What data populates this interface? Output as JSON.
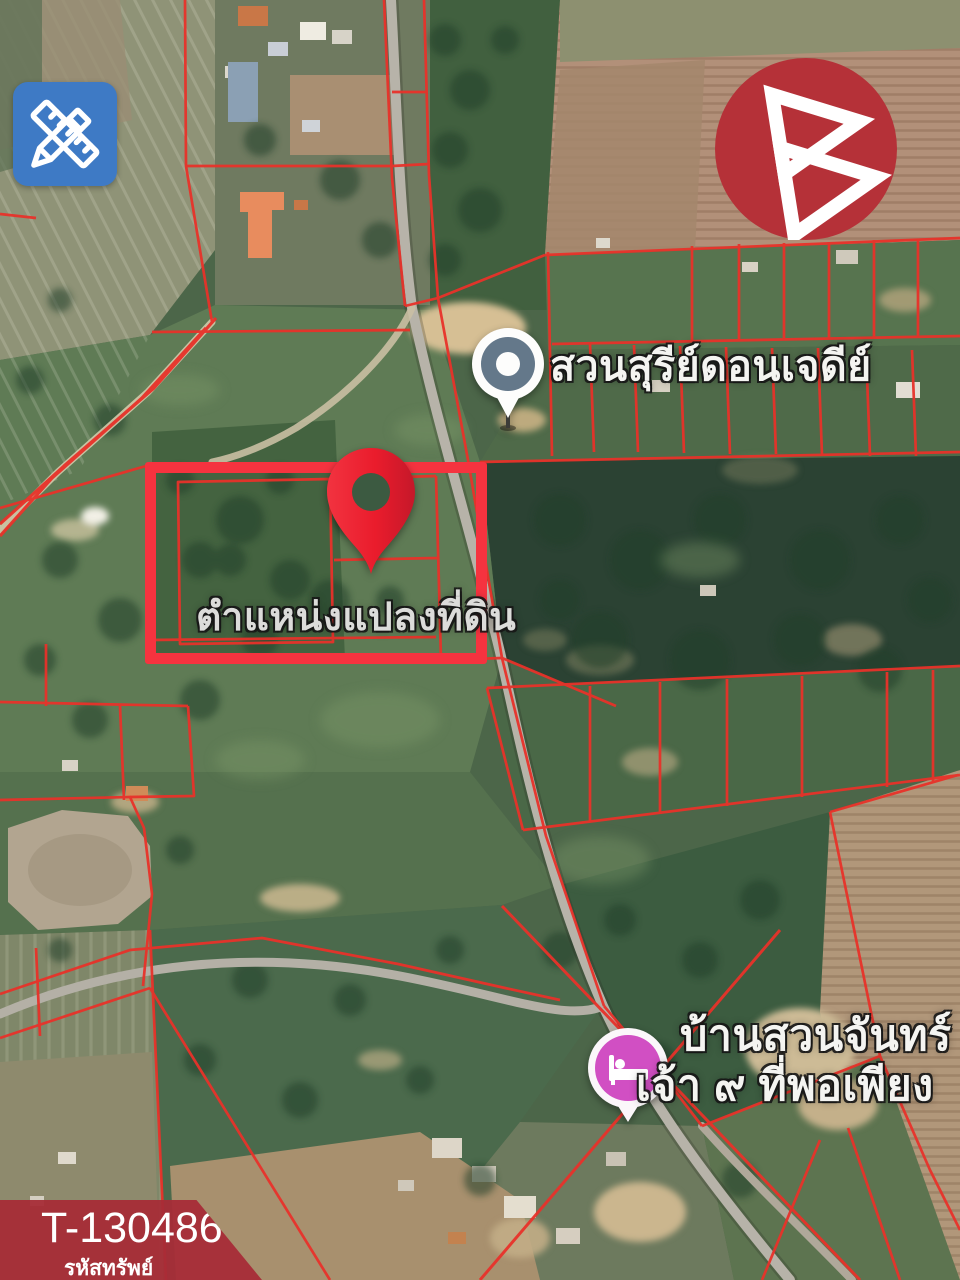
{
  "image": {
    "width": 960,
    "height": 1280,
    "kind": "real-estate-listing-satellite-map"
  },
  "overlays": {
    "edit_icon": {
      "name": "ruler-pencil-edit-icon",
      "bg_color": "#3e7ac5"
    },
    "brand_logo": {
      "name": "b-triangle-logo",
      "bg_color": "#b53138",
      "glyph_color": "#ffffff"
    }
  },
  "map": {
    "poi_garden_label": "สวนสุรีย์ดอนเจดีย์",
    "plot_label": "ตำแหน่งแปลงที่ดิน",
    "lodging_label_line1": "บ้านสวนจันทร์",
    "lodging_label_line2": "เจ้า ๙ ที่พอเพียง",
    "highlight_color": "#f5333f",
    "cadastral_line_color": "#e8322a",
    "plot_pin_color": "#ea1c2c",
    "lodging_pin_color": "#d14fc3",
    "poi_pin_disc_color": "#64788a"
  },
  "footer": {
    "property_code": "T-130486",
    "property_code_label": "รหัสทรัพย์",
    "banner_color": "#a72c37"
  }
}
